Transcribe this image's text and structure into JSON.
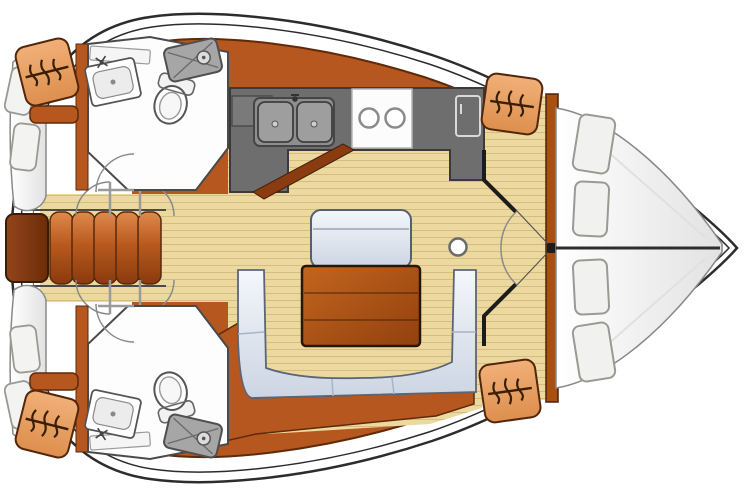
{
  "meta": {
    "title": "Sailboat interior layout - top-down floor plan",
    "type": "yacht-floor-plan",
    "orientation": "bow-right"
  },
  "colors": {
    "hull_white": "#ffffff",
    "outline_dark": "#2c2c2c",
    "wood_band": "#b5571e",
    "wood_band_dark": "#5f2a0a",
    "plank_front": "#8a3c10",
    "floor": "#ecd9a0",
    "plank_line": "#d6bc7e",
    "counter": "#6e6e6e",
    "counter_dark": "#3a3a3a",
    "step_light": "#e08a4e",
    "step_dark": "#8a3a0e",
    "landing_brown": "#7a3510",
    "locker_orange": "#e89c5c",
    "locker_outline": "#53260a",
    "table_light": "#c2661f",
    "table_dark": "#93400e",
    "settee_light": "#f4f7fb",
    "settee_shadow": "#ccd5e3",
    "berth_white": "#fafafa",
    "fixture_outline": "#555555",
    "shower_gray": "#a6a6a6",
    "icon_brown": "#3c1e05"
  },
  "rooms": {
    "forward_cabin": {
      "name": "forward-cabin",
      "berth": "V-berth double",
      "pillows": 4,
      "hanging_lockers": 2
    },
    "salon": {
      "name": "salon",
      "settee": "U-shaped settee",
      "table_leaves": 3,
      "bench_seats": 1,
      "mast_post": 1
    },
    "galley": {
      "name": "galley",
      "sinks": 2,
      "burners": 2,
      "refrigerator": 1,
      "counter_hatch": 1
    },
    "head_port": {
      "name": "port-head",
      "toilet": 1,
      "sink": 1,
      "shower": 1
    },
    "head_starboard": {
      "name": "starboard-head",
      "toilet": 1,
      "sink": 1,
      "shower": 1
    },
    "aft_cabin_port": {
      "name": "port-aft-berth",
      "pillows": 2,
      "hanging_locker": 1
    },
    "aft_cabin_starboard": {
      "name": "starboard-aft-berth",
      "pillows": 2,
      "hanging_locker": 1
    },
    "companionway": {
      "name": "companionway",
      "steps": 5
    }
  },
  "icons": [
    "hanger-icon",
    "shower-icon",
    "toilet-icon",
    "sink-icon",
    "stove-icon",
    "fridge-icon",
    "door-arc-icon",
    "mast-post-icon"
  ]
}
